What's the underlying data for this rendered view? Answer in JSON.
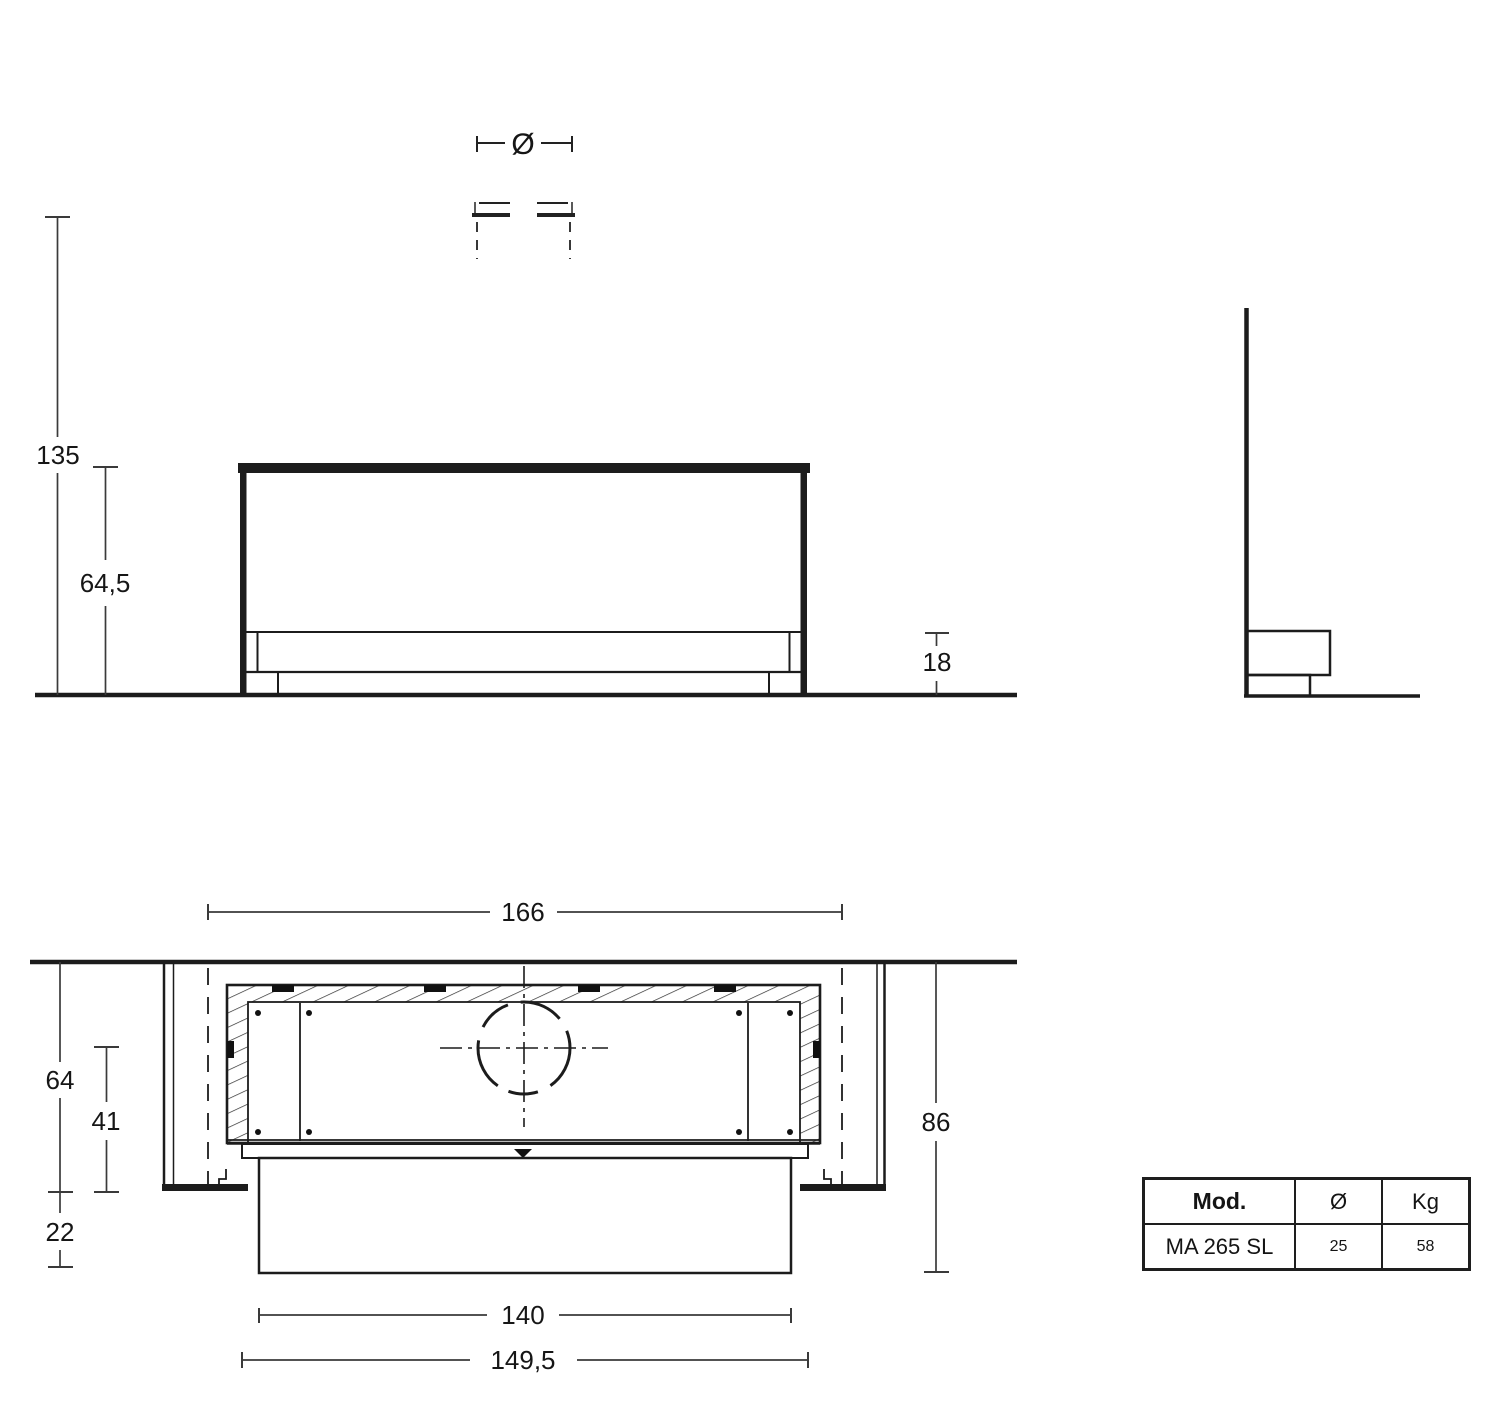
{
  "dims": {
    "total_height": "135",
    "box_height": "64,5",
    "base_height": "18",
    "diameter_symbol": "Ø",
    "niche_width": "166",
    "depth_total": "64",
    "depth_inner": "41",
    "front_offset": "22",
    "overall_depth": "86",
    "inner_width": "140",
    "frame_width": "149,5"
  },
  "table": {
    "headers": [
      "Mod.",
      "Ø",
      "Kg"
    ],
    "row": [
      "MA 265 SL",
      "25",
      "58"
    ]
  },
  "colors": {
    "line": "#1c1c1c",
    "dim_line": "#3a3a3a",
    "background": "#ffffff"
  }
}
